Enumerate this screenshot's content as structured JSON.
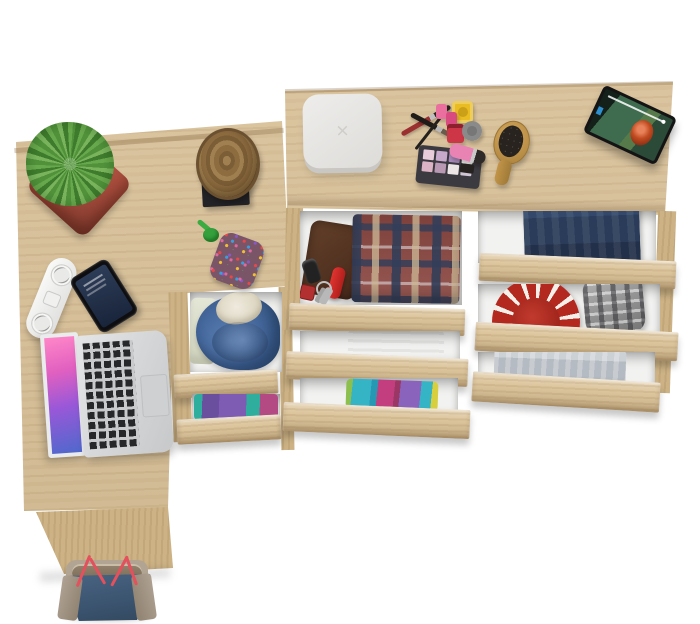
{
  "scene": {
    "type": "product-photo",
    "alt": "Top-down view of a light oak corner desk with drawer pedestal and a chest of drawers; drawers are pulled open showing folded clothes and accessories",
    "background": "#ffffff"
  },
  "palette": {
    "wood": "#d8c097",
    "wood_front": "#ddc69e",
    "wood_side": "#ccb285",
    "drawer_interior": "#f2f2f1",
    "accent_red": "#b3291f",
    "denim_blue": "#2a3c59",
    "hoodie_blue": "#46699e"
  },
  "furniture": {
    "desk": {
      "label": "corner desk worktop, oak"
    },
    "desk_return": {
      "label": "desk side panel, oak"
    },
    "dresser_top": {
      "label": "dresser worktop, oak"
    },
    "pedestal_drawers": [
      {
        "label": "open drawer with blue hoodie and cream shirt"
      },
      {
        "label": "open drawer with purple and teal folded clothes"
      }
    ],
    "middle_drawers": [
      {
        "label": "open drawer with leather wallet, keys, pocket knife and plaid shirt"
      },
      {
        "label": "open drawer with folded grey towel"
      },
      {
        "label": "open drawer with colourful folded clothes"
      }
    ],
    "right_drawers": [
      {
        "label": "open drawer with folded jeans"
      },
      {
        "label": "open drawer with red patterned hat and grey plaid cap"
      },
      {
        "label": "open drawer with folded grey shirt"
      }
    ]
  },
  "items": {
    "white_box": {
      "label": "white storage box",
      "mark": "×",
      "color": "#e7e6e3"
    },
    "plant": {
      "label": "succulent in red square pot",
      "foliage": "#4f8f3a",
      "pot": "#b05546"
    },
    "stump": {
      "label": "decorative wooden log on black stand"
    },
    "pouch": {
      "label": "multicolour beaded pouch with green cord"
    },
    "power_strip": {
      "label": "white power strip"
    },
    "phone": {
      "label": "black smartphone, lock screen"
    },
    "laptop": {
      "label": "open silver laptop with pink wallpaper"
    },
    "makeup": {
      "label": "makeup set: two brushes, eyeliner, eyeshadow palette, nail polishes, lipstick",
      "palette_shades": [
        "#e9ccd9",
        "#c9a9cb",
        "#a989b9",
        "#f2f1ee",
        "#dcb3c4",
        "#b898b2",
        "#ece6e6",
        "#cfc6d6"
      ]
    },
    "hairbrush": {
      "label": "wooden oval hair brush"
    },
    "tablet": {
      "label": "tablet playing an animated movie, progress bar visible"
    },
    "bag": {
      "label": "denim tote bag with red straps"
    }
  }
}
